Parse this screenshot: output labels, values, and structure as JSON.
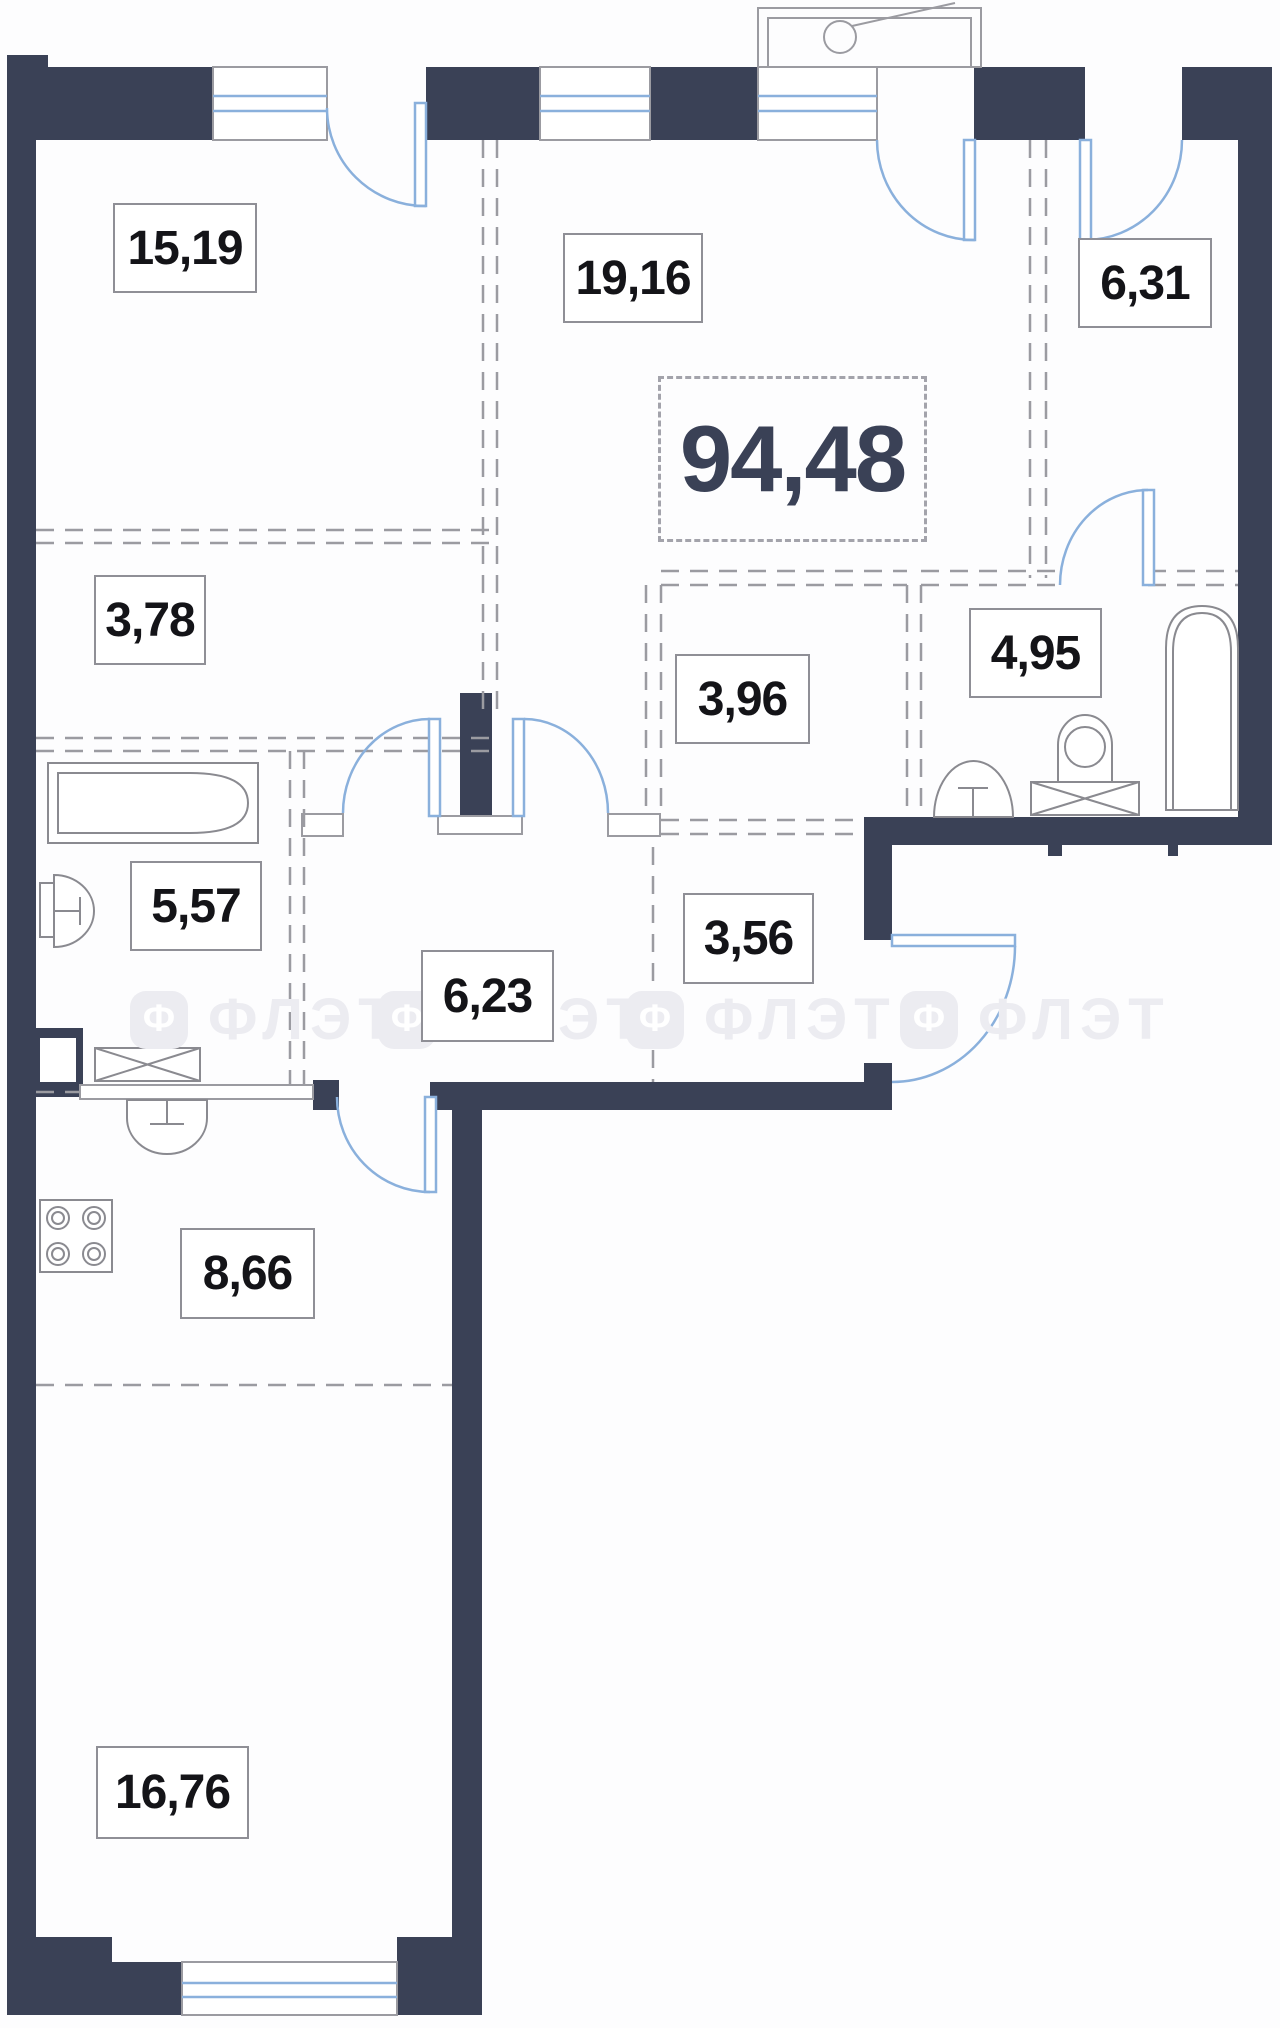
{
  "plan": {
    "total_area": "94,48",
    "rooms": [
      {
        "name": "room-15-19",
        "area": "15,19"
      },
      {
        "name": "room-19-16",
        "area": "19,16"
      },
      {
        "name": "room-6-31",
        "area": "6,31"
      },
      {
        "name": "wardrobe-3-78",
        "area": "3,78"
      },
      {
        "name": "storage-3-96",
        "area": "3,96"
      },
      {
        "name": "bathroom-4-95",
        "area": "4,95"
      },
      {
        "name": "bathroom-5-57",
        "area": "5,57"
      },
      {
        "name": "hallway-6-23",
        "area": "6,23"
      },
      {
        "name": "hallway-3-56",
        "area": "3,56"
      },
      {
        "name": "kitchen-8-66",
        "area": "8,66"
      },
      {
        "name": "room-16-76",
        "area": "16,76"
      }
    ],
    "watermark": {
      "text": "ФЛЭТ",
      "logo_letter": "Ф"
    },
    "colors": {
      "wall": "#3A4156",
      "door_blue": "#8AB0DC",
      "line_gray": "#9B9BA1",
      "label_text": "#141418",
      "watermark": "#ECECF1"
    }
  }
}
